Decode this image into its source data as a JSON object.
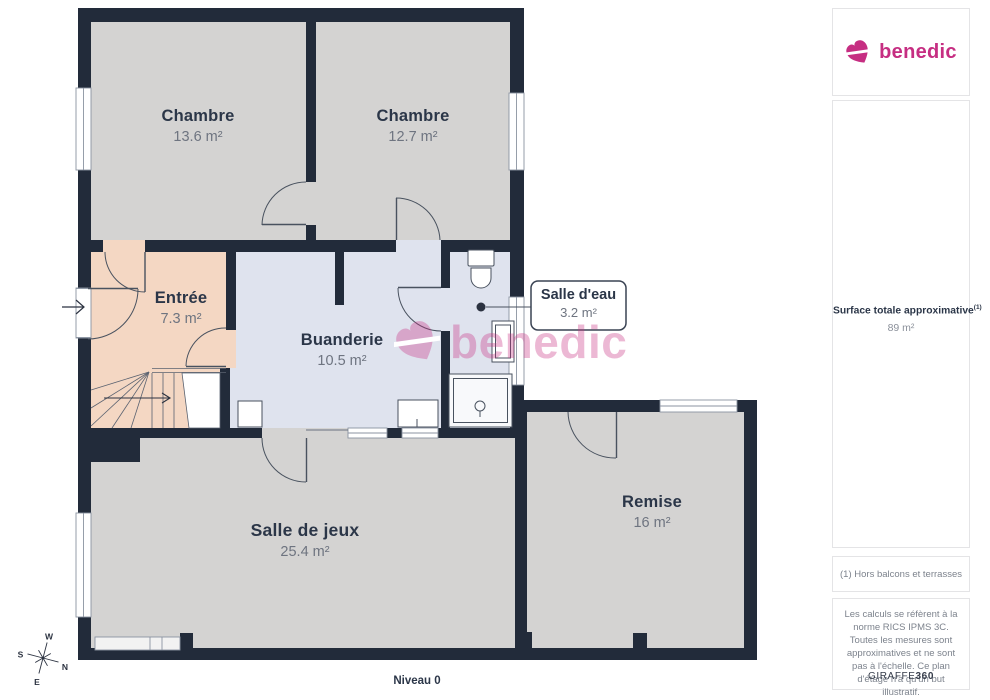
{
  "brand": {
    "name": "benedic",
    "color": "#c62e82"
  },
  "plan": {
    "level_label": "Niveau 0",
    "watermark_text": "benedic",
    "wall_color": "#222b3a",
    "compass": {
      "n": "N",
      "s": "S",
      "e": "E",
      "w": "W"
    },
    "rooms": [
      {
        "id": "chambre-1",
        "name": "Chambre",
        "area": "13.6 m²",
        "color": "#d4d3d2"
      },
      {
        "id": "chambre-2",
        "name": "Chambre",
        "area": "12.7 m²",
        "color": "#d4d3d2"
      },
      {
        "id": "entree",
        "name": "Entrée",
        "area": "7.3 m²",
        "color": "#f4d7c3"
      },
      {
        "id": "buanderie",
        "name": "Buanderie",
        "area": "10.5 m²",
        "color": "#dfe3ee"
      },
      {
        "id": "salle-eau",
        "name": "Salle d'eau",
        "area": "3.2 m²",
        "color": "#dfe3ee"
      },
      {
        "id": "salle-de-jeux",
        "name": "Salle de jeux",
        "area": "25.4 m²",
        "color": "#d4d3d2"
      },
      {
        "id": "remise",
        "name": "Remise",
        "area": "16 m²",
        "color": "#d4d3d2"
      }
    ]
  },
  "sidebar": {
    "surface_label": "Surface totale approximative",
    "surface_sup": "(1)",
    "surface_value": "89 m²",
    "note": "(1) Hors balcons et terrasses",
    "disclaimer": "Les calculs se réfèrent à la norme RICS IPMS 3C. Toutes les mesures sont approximatives et ne sont pas à l'échelle. Ce plan d'étage n'a qu'un but illustratif.",
    "credit_name": "GIRAFFE",
    "credit_number": "360"
  }
}
